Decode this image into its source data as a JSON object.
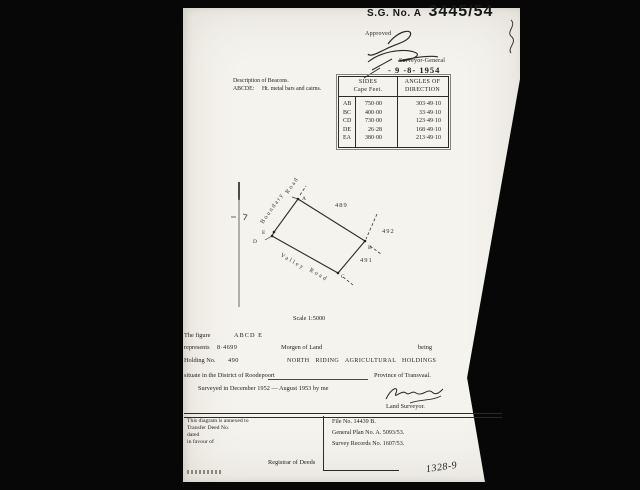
{
  "header": {
    "sg_label": "S.G. No. A",
    "sg_number": "3445/54",
    "approved_label": "Approved",
    "approver_title": "Surveyor-General",
    "approval_date": "- 9 -8- 1954"
  },
  "beacons": {
    "title": "Description of Beacons.",
    "letters": "ABCDE:",
    "description": "Ht. metal bars and cairns."
  },
  "sides_table": {
    "header_sides_1": "SIDES",
    "header_sides_2": "Cape Feet.",
    "header_angles_1": "ANGLES OF",
    "header_angles_2": "DIRECTION",
    "rows": [
      {
        "side": "AB",
        "length": "750·00",
        "angle": "303·49·10"
      },
      {
        "side": "BC",
        "length": "400·00",
        "angle": "33·49·10"
      },
      {
        "side": "CD",
        "length": "730·00",
        "angle": "123·49·10"
      },
      {
        "side": "DE",
        "length": "26·28",
        "angle": "168·49·10"
      },
      {
        "side": "EA",
        "length": "380·00",
        "angle": "213·49·10"
      }
    ]
  },
  "diagram": {
    "polygon_points": "298,199 365,241 338,273 272,236 274,232",
    "vertex_dots": "M298 199h.01M365 241h.01M338 273h.01M272 236h.01M274 232h.01",
    "dash_beyond_a": "300,195 306,186",
    "dash_into_b": "377,214 366,239",
    "dash_beyond_b": "370,246 381,254",
    "dash_beyond_c": "343,277 353,285",
    "corner_a": "A",
    "corner_b": "B",
    "corner_c": "C",
    "corner_d": "D",
    "corner_e": "E",
    "parcel_north": "489",
    "parcel_east": "492",
    "parcel_south": "491",
    "road_boundary": [
      "Boundary",
      "Road"
    ],
    "road_valley": [
      "Valley",
      "Road"
    ],
    "scale_label": "Scale 1:5000"
  },
  "statement": {
    "figure_label": "The figure",
    "figure_letters": "ABCD E",
    "represents_label": "represents",
    "area_value": "8·4699",
    "area_unit": "Morgen of Land",
    "being_label": "being",
    "holding_label": "Holding No.",
    "holding_value": "490",
    "holding_name": "NORTH RIDING AGRICULTURAL HOLDINGS",
    "situate_text": "situate in the District of Roodepoort",
    "province_text": "Province of Transvaal.",
    "surveyed_text": "Surveyed in December 1952 — August 1953 by me",
    "surveyor_title": "Land Surveyor."
  },
  "footer": {
    "annexed_lines": [
      "This diagram is annexed to",
      "Transfer Deed No.",
      "dated",
      "in favour of"
    ],
    "registrar_label": "Registrar of Deeds",
    "file_no": "File No. 14439 B.",
    "general_plan_no": "General Plan No. A. 5093/53.",
    "survey_records_no": "Survey Records No. 1607/53.",
    "handwritten_ref": "1328-9"
  }
}
